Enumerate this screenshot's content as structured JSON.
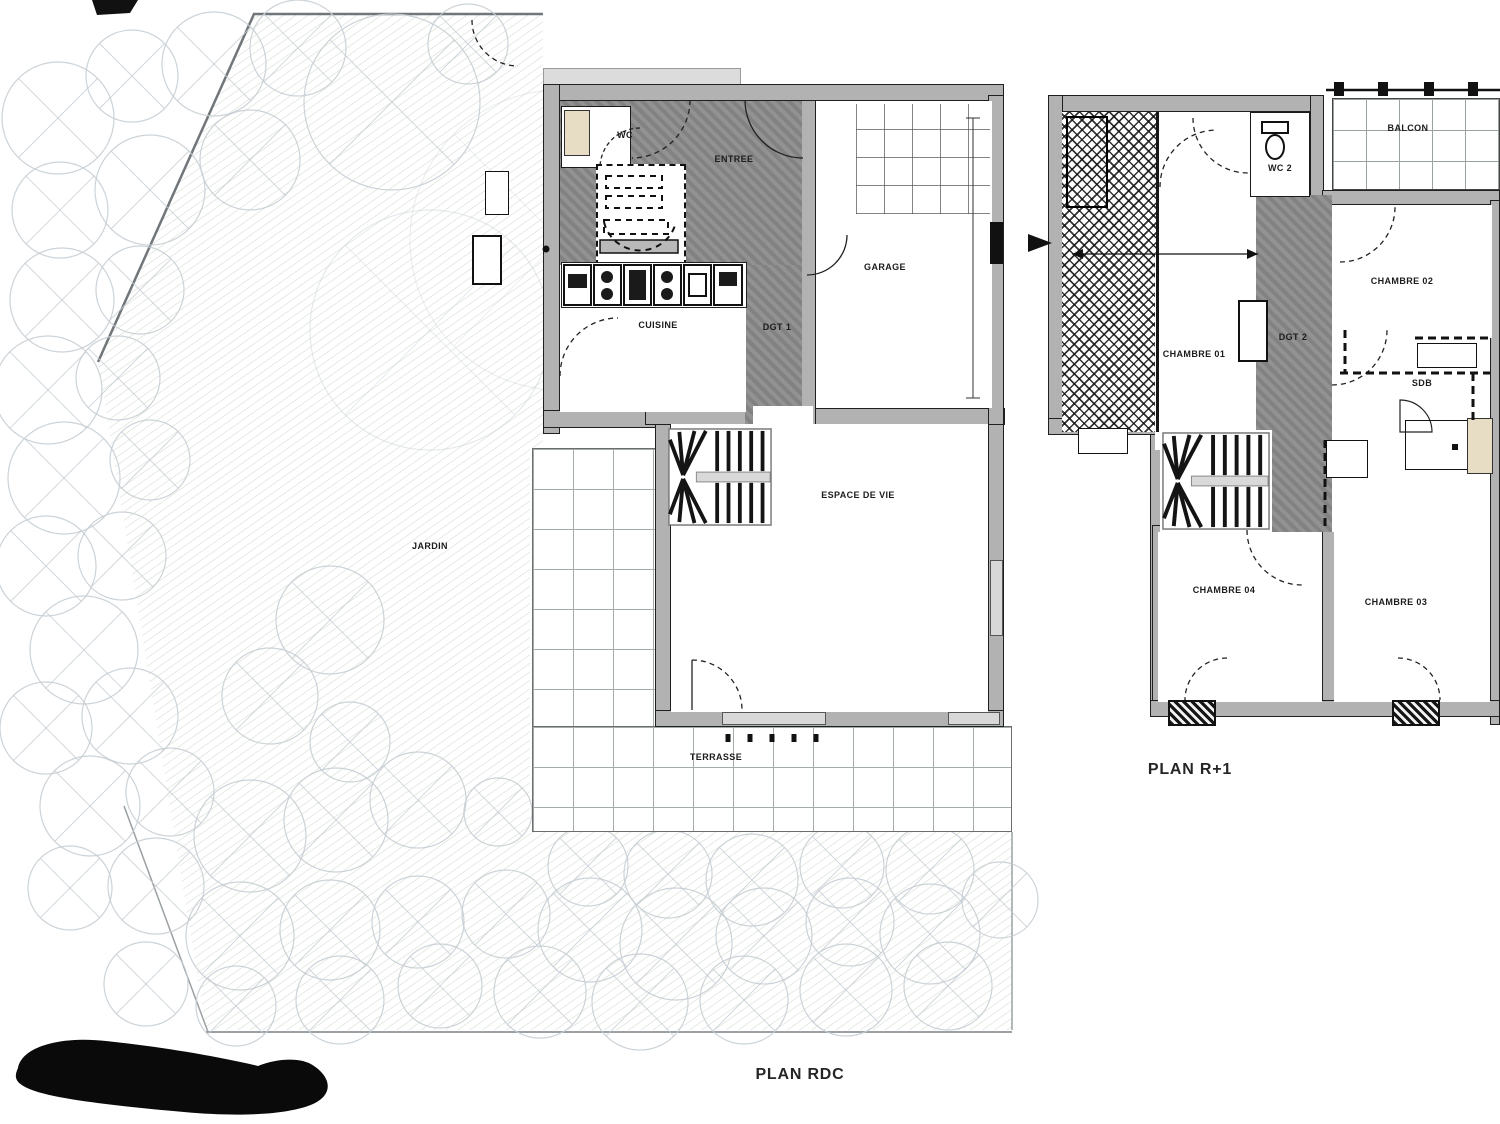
{
  "plans": {
    "rdc": {
      "title": "PLAN RDC",
      "rooms": {
        "jardin": "JARDIN",
        "wc": "WC",
        "entree": "ENTREE",
        "cuisine": "CUISINE",
        "dgt1": "DGT 1",
        "garage": "GARAGE",
        "espace_de_vie": "ESPACE DE VIE",
        "terrasse": "TERRASSE"
      }
    },
    "r1": {
      "title": "PLAN R+1",
      "rooms": {
        "wc2": "WC 2",
        "balcon": "BALCON",
        "chambre01": "CHAMBRE 01",
        "chambre02": "CHAMBRE 02",
        "chambre03": "CHAMBRE 03",
        "chambre04": "CHAMBRE 04",
        "dgt2": "DGT 2",
        "sdb": "SDB"
      }
    }
  },
  "colors": {
    "wall_gray": "#b2b2b2",
    "hatch_gray": "#8b8b8b",
    "tile_line": "#a4abab",
    "tree_outline": "#c6ced4",
    "ink": "#1c1c1c"
  }
}
